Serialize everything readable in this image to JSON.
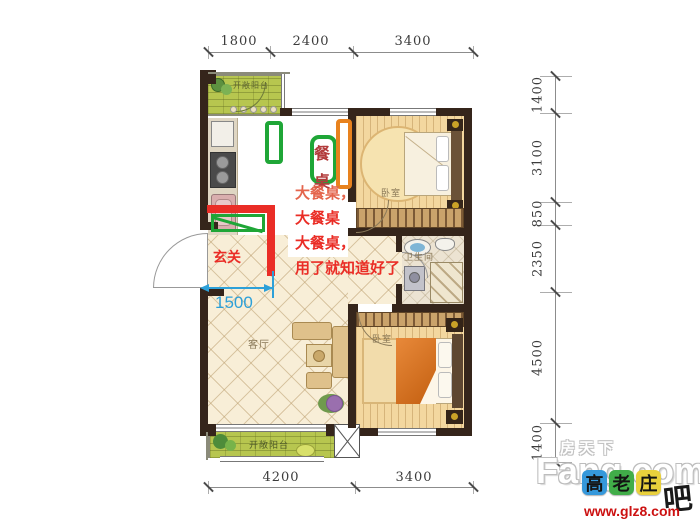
{
  "colors": {
    "wall": "#35251b",
    "balcony": "#b7c64f",
    "ann-red": "#ea2d26",
    "ann-red-light": "#e4654d",
    "ann-darkred": "#b23b3b",
    "ann-green": "#1fa637",
    "ann-orange": "#e8821e",
    "ann-blue": "#2da0d8",
    "glz-blue": "#3598db",
    "glz-green": "#41ad49",
    "glz-yellow": "#e9d03c",
    "url-red": "#cc1111"
  },
  "dims": {
    "top": [
      "1800",
      "2400",
      "3400"
    ],
    "bottom": [
      "4200",
      "3400"
    ],
    "right": [
      "1400",
      "3100",
      "850",
      "2350",
      "4500",
      "1400"
    ]
  },
  "rooms": {
    "balcony_top": "开敞阳台",
    "bedroom_top": "卧室",
    "bathroom": "卫生间",
    "bedroom_bottom": "卧室",
    "living": "客厅",
    "entry": "玄关",
    "balcony_bottom": "开敞阳台"
  },
  "annotations": {
    "table_top": "餐",
    "table_bottom": "桌",
    "notes": [
      "大餐桌，",
      "大餐桌",
      "大餐桌，",
      "用了就知道好了"
    ],
    "measure": "1500"
  },
  "watermarks": {
    "fang_cn": "房天下",
    "fang_en": "Fang.com",
    "glz": [
      "高",
      "老",
      "庄"
    ],
    "glz_suffix": "吧",
    "glz_url": "www.glz8.com"
  }
}
